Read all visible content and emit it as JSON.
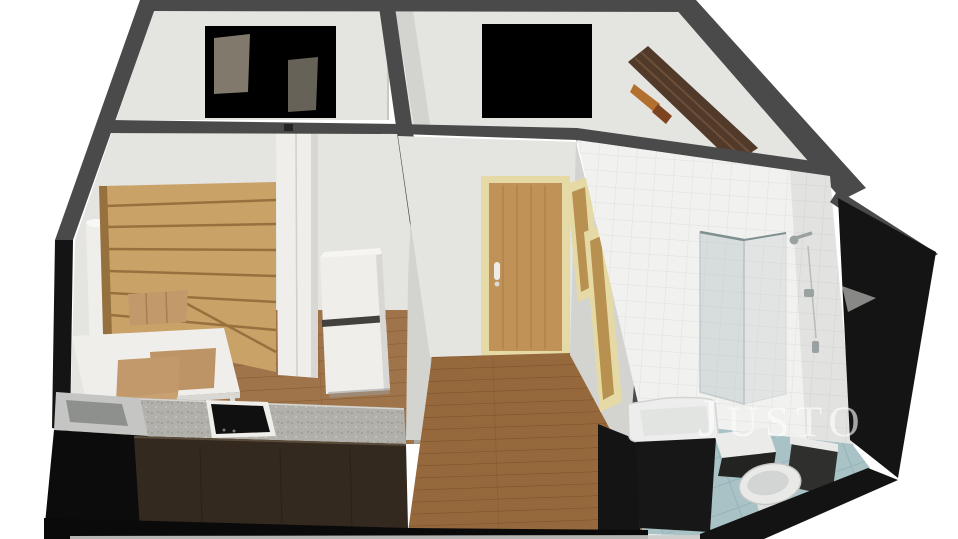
{
  "watermark": {
    "first_letter": "J",
    "rest": "USTO"
  },
  "colors": {
    "background": "#ffffff",
    "wall_cut": "#4a4a4a",
    "wall_cut_light": "#a9a9a5",
    "exterior": "#141414",
    "wall_face": "#e4e4e1",
    "wall_face_shade": "#d3d3d0",
    "wall_face_dark": "#c2c2bf",
    "white_furn": "#efeeea",
    "white_furn_shade": "#d8d7d3",
    "oak": "#c9a268",
    "oak_shadow": "#96713e",
    "shelf_dark": "#513a2a",
    "shelf_line": "#6e4f38",
    "book_orange": "#b36f2e",
    "book_brown": "#7e4420",
    "floor_wood": "#a0744a",
    "floor_wood_dark": "#96693c",
    "plank_line": "#84582f",
    "plank_line_dark": "#7a4f2a",
    "door_wood": "#c09258",
    "door_wood_dark": "#b8904f",
    "door_frame": "#e5daa5",
    "counter_top": "#b2b0ab",
    "counter_front": "#33291f",
    "cooktop": "#101010",
    "tile_wall": "#f1f1ef",
    "tile_grout": "#e0e0de",
    "tile_floor": "#a8c2c6",
    "tile_floor_grout": "#8fb0b4",
    "glass": "#b9c6c6",
    "chrome": "#99a1a1",
    "toilet_white": "#e9eae8",
    "watermark": "#ffffff"
  }
}
